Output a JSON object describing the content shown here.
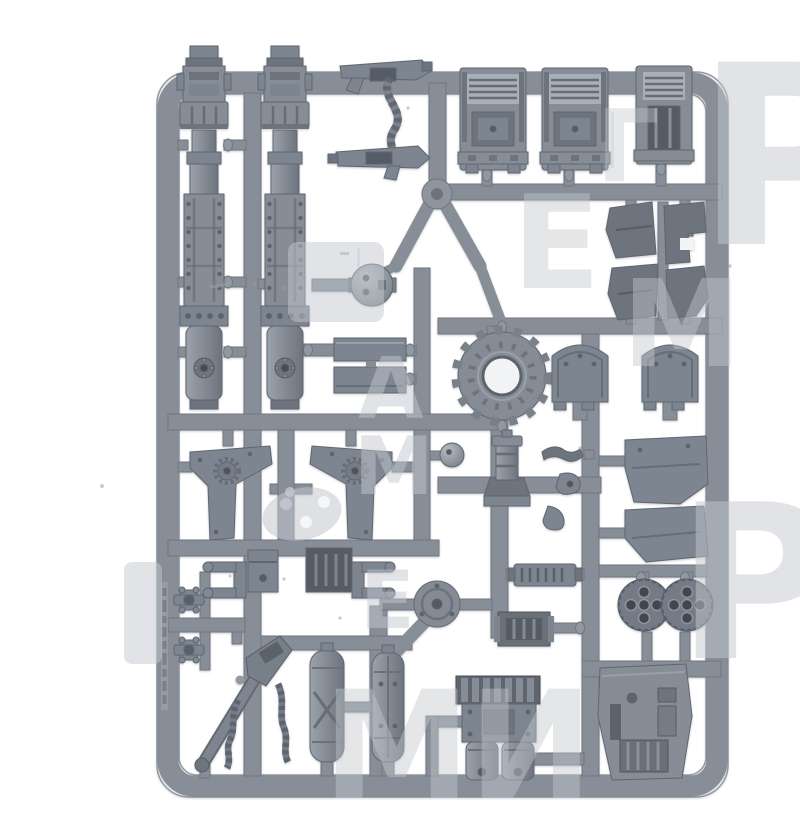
{
  "meta": {
    "type": "product-photo",
    "subject": "Grey plastic model-kit sprue (miniature vehicle parts frame) on a white background with a pale grey store watermark",
    "background_color": "#ffffff"
  },
  "palette": {
    "plastic": "#868d97",
    "plastic_mid": "#7d8590",
    "plastic_dark": "#6e747e",
    "plastic_darker": "#565c66",
    "plastic_light": "#a9afb7",
    "detail_dark": "#474c54",
    "hole_white": "#f3f4f6",
    "watermark": "#c4c8ce"
  },
  "watermark": {
    "opacity": 0.5,
    "glyphs": [
      "Р",
      "Р",
      "Е",
      "М",
      "А",
      "М",
      "Е",
      "М",
      "И",
      "Г"
    ]
  },
  "parts": [
    {
      "name": "cannon-barrel-left",
      "desc": "Long segmented cannon barrel"
    },
    {
      "name": "cannon-barrel-right",
      "desc": "Long segmented cannon barrel (pair)"
    },
    {
      "name": "storm-bolter-upper",
      "desc": "Boxy gun with magazine"
    },
    {
      "name": "ammo-chain",
      "desc": "Zig-zag ammunition feed belt"
    },
    {
      "name": "storm-bolter-lower",
      "desc": "Boxy gun with magazine (pair)"
    },
    {
      "name": "vent-housing-1",
      "desc": "Louvred engine housing block"
    },
    {
      "name": "vent-housing-2",
      "desc": "Louvred engine housing block (pair)"
    },
    {
      "name": "vent-housing-3",
      "desc": "Narrow louvred housing block"
    },
    {
      "name": "ball-joint-large",
      "desc": "Spherical joint with sockets"
    },
    {
      "name": "ball-joint-small",
      "desc": "Small spherical joint"
    },
    {
      "name": "armor-plate-pair",
      "desc": "Two small rectangular armour plates"
    },
    {
      "name": "gear-ring",
      "desc": "Toothed cog ring with open hub"
    },
    {
      "name": "cowl-panel-left",
      "desc": "Curved cowl armour panel"
    },
    {
      "name": "cowl-panel-right",
      "desc": "Curved cowl armour panel (pair)"
    },
    {
      "name": "angular-plate-set",
      "desc": "Four flat angular armour plates"
    },
    {
      "name": "wing-panel-left",
      "desc": "Winged side panel with cog emblem"
    },
    {
      "name": "wing-panel-right",
      "desc": "Winged side panel with cog emblem (pair)"
    },
    {
      "name": "exhaust-stack",
      "desc": "Small stack with flared skirt"
    },
    {
      "name": "chain-fragments",
      "desc": "Small curved chain and blade pieces"
    },
    {
      "name": "armor-plate-right-upper",
      "desc": "Large angular hull plate"
    },
    {
      "name": "armor-plate-right-lower",
      "desc": "Large angular hull plate (pair)"
    },
    {
      "name": "clevis-fork-left",
      "desc": "U-shaped clevis bracket"
    },
    {
      "name": "clevis-fork-right",
      "desc": "U-shaped clevis bracket (pair)"
    },
    {
      "name": "mount-box",
      "desc": "Small mounting box"
    },
    {
      "name": "grille-box",
      "desc": "Dark box with vertical grille"
    },
    {
      "name": "cross-hinge-pair",
      "desc": "Two small cross-shaped hinges"
    },
    {
      "name": "heavy-bolter",
      "desc": "Slanted heavy gun with two hanging ammo belts"
    },
    {
      "name": "fuel-tank-pair",
      "desc": "Two cylindrical tanks"
    },
    {
      "name": "vent-plate",
      "desc": "Small slatted vent plate"
    },
    {
      "name": "gearbox-block",
      "desc": "Grilled gearbox block"
    },
    {
      "name": "turret-disc",
      "desc": "Flat turret ring disc"
    },
    {
      "name": "engine-block",
      "desc": "Engine block with twin pistons"
    },
    {
      "name": "rear-hull-plate",
      "desc": "Rear hull plate with vents"
    },
    {
      "name": "missile-pod-pair",
      "desc": "Twin multi-barrel missile pods"
    },
    {
      "name": "hinge-pins",
      "desc": "Tiny hinge pin pieces"
    }
  ]
}
